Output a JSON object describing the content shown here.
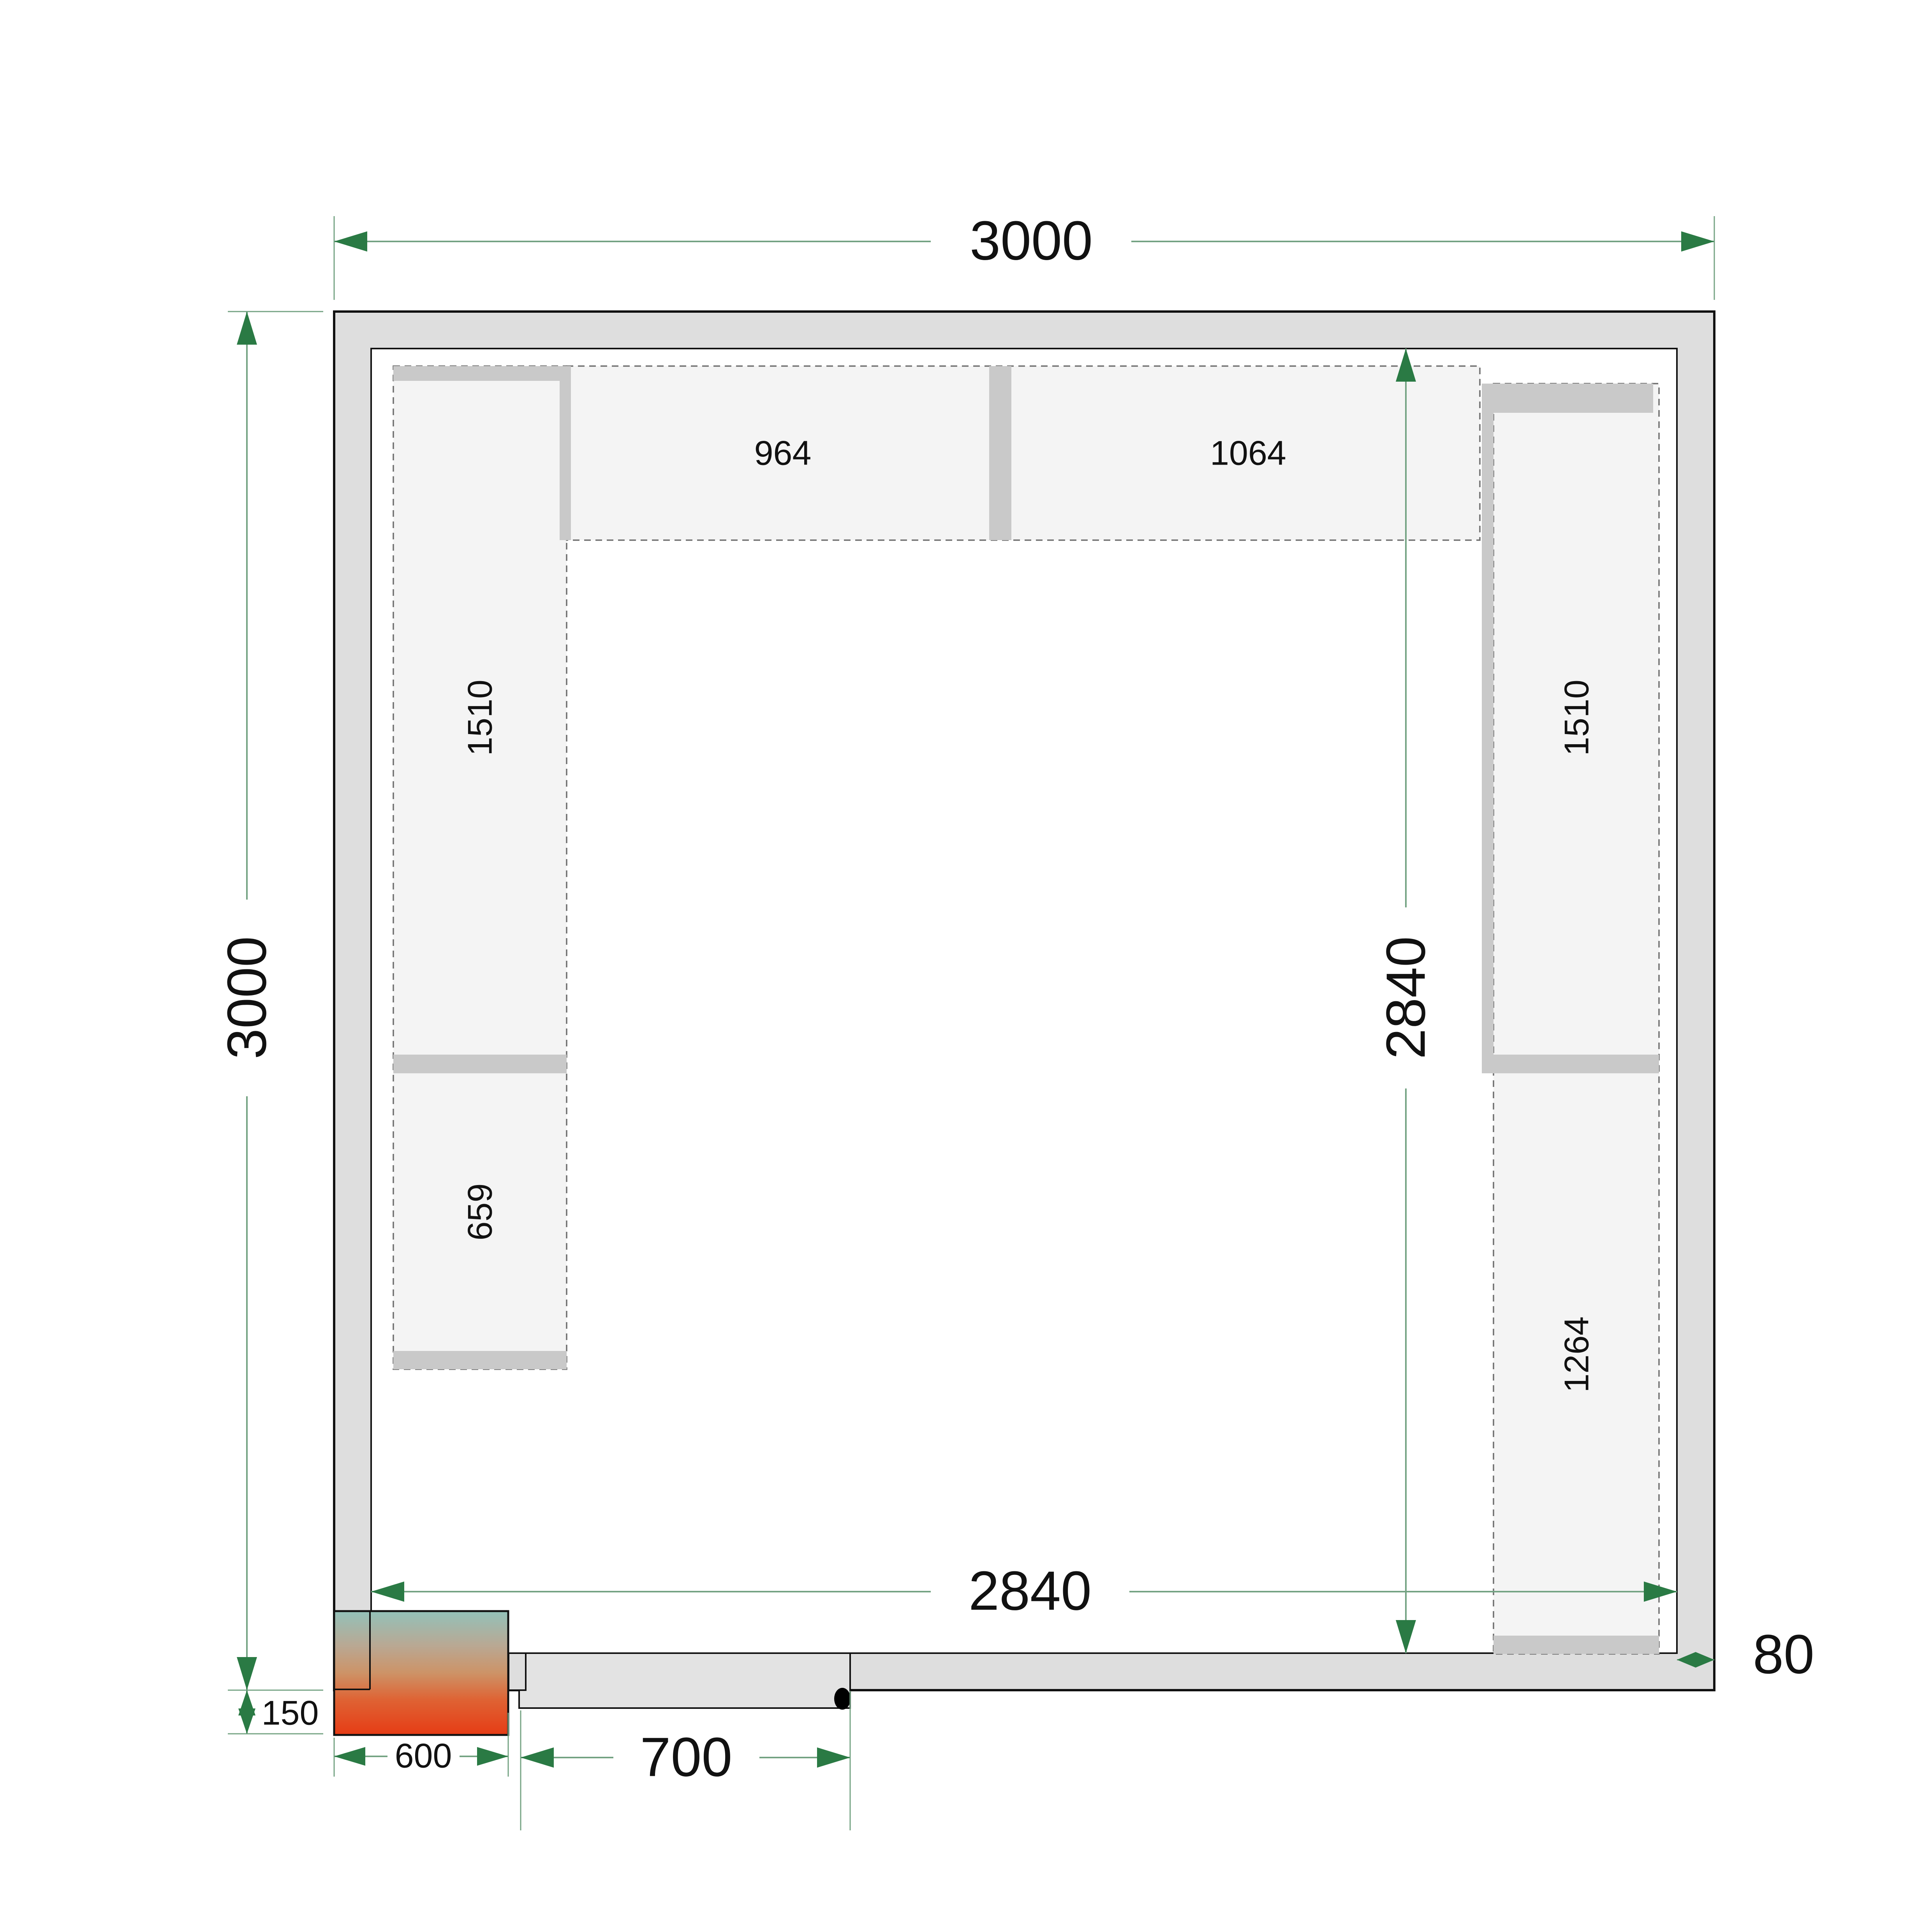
{
  "drawing": {
    "type": "cold-room floor plan, top view",
    "units": "mm"
  },
  "labels": {
    "outer_width_top": "3000",
    "outer_height_left": "3000",
    "inner_height_right": "2840",
    "inner_width_bottom": "2840",
    "wall_thickness": "80",
    "unit_protrusion": "150",
    "unit_width": "600",
    "door_width": "700",
    "shelf_top_left": "964",
    "shelf_top_right": "1064",
    "shelf_left_upper": "1510",
    "shelf_left_lower": "659",
    "shelf_right_upper": "1510",
    "shelf_right_lower": "1264"
  },
  "colors": {
    "dimension_line": "#74a383",
    "dimension_arrow": "#2a7a44",
    "wall_fill": "#dedede",
    "room_fill": "#ffffff",
    "shelf_fill": "#f4f4f4",
    "support_fill": "#c9c9c9",
    "door_leaf_fill": "#e3e3e3",
    "hinge_dot": "#000000",
    "unit_gradient_top": "#93c1b9",
    "unit_gradient_upper_mid": "#b9a893",
    "unit_gradient_mid": "#cd9367",
    "unit_gradient_lower_mid": "#df6233",
    "unit_gradient_bottom": "#e63c15"
  }
}
